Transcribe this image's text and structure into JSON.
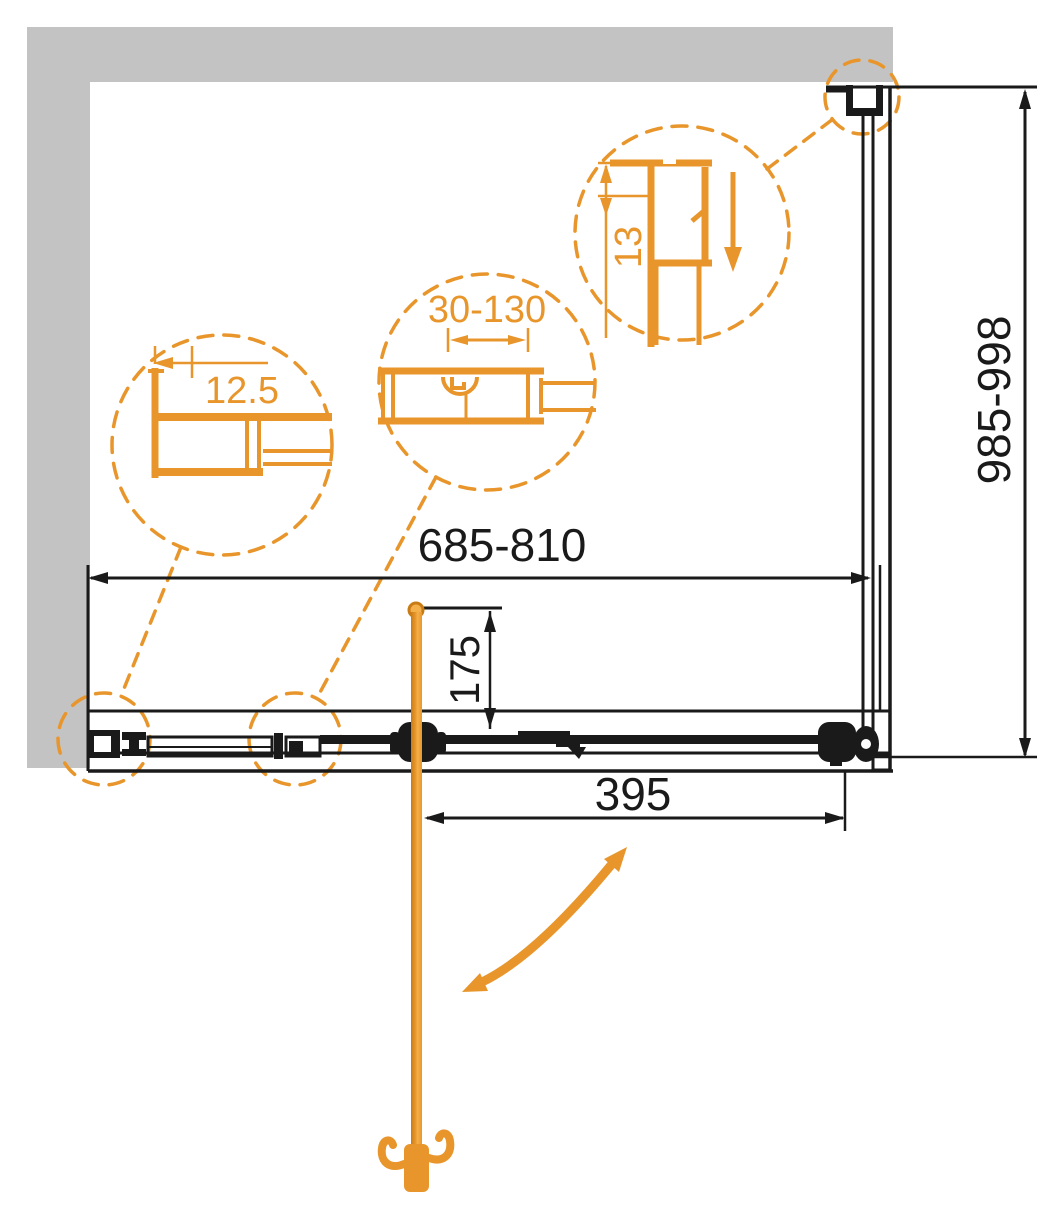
{
  "dimensions": {
    "width_range": "685-810",
    "depth_range": "985-998",
    "handle_offset": "175",
    "door_opening": "395"
  },
  "details": {
    "left_circle_value": "12.5",
    "middle_circle_value": "30-130",
    "right_circle_value": "13"
  },
  "colors": {
    "accent_orange": "#e8962b",
    "accent_orange_dark": "#c97c15",
    "accent_orange_light": "#f4b04a",
    "line_black": "#1a1a1a",
    "wall_gray": "#c3c3c3",
    "background": "#ffffff"
  }
}
